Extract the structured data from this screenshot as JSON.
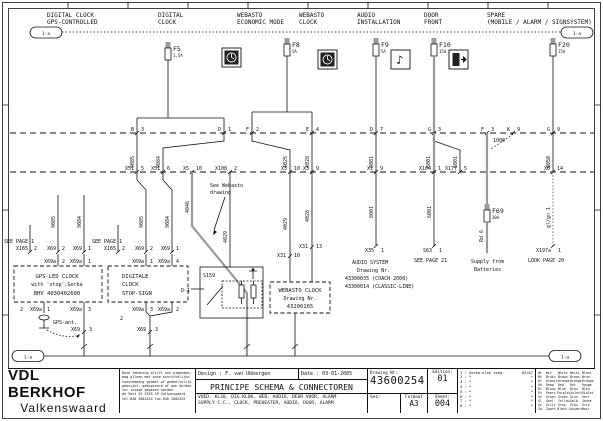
{
  "t": {
    "bub": "1-a",
    "h1a": "DIGITAL CLOCK",
    "h1b": "GPS-CONTROLLED",
    "h2a": "DIGITAL",
    "h2b": "CLOCK",
    "h3a": "WEBASTO",
    "h3b": "ECONOMIC MODE",
    "h4a": "WEBASTO",
    "h4b": "CLOCK",
    "h5a": "AUDIO",
    "h5b": "INSTALLATION",
    "h6a": "DOOR",
    "h6b": "FRONT",
    "h7a": "SPARE",
    "h7b": "(MOBILE / ALARM / SIGNSYSTEM)",
    "see1": "SEE PAGE 1",
    "seew1": "See Webasto",
    "seew2": "drawing",
    "see21": "SEE PAGE 21",
    "sup1": "Supply from",
    "sup2": "Batteries",
    "look20": "LOOK PAGE 20",
    "gpsant": "GPS-ant.",
    "s159": "S159",
    "d1": "D-1",
    "two": "2"
  },
  "fuses": {
    "f5": {
      "name": "F5",
      "rating": "1,5A"
    },
    "f8": {
      "name": "F8",
      "rating": "5A"
    },
    "f9": {
      "name": "F9",
      "rating": "5A"
    },
    "f10": {
      "name": "F10",
      "rating": "15A"
    },
    "f20": {
      "name": "F20",
      "rating": "15A"
    },
    "f69": {
      "name": "F69",
      "rating": "30A"
    }
  },
  "bus1": [
    {
      "l": "B",
      "n": "3"
    },
    {
      "l": "D",
      "n": "1"
    },
    {
      "l": "F",
      "n": "2"
    },
    {
      "l": "E",
      "n": "4"
    },
    {
      "l": "D",
      "n": "7"
    },
    {
      "l": "G",
      "n": "3"
    },
    {
      "l": "F",
      "n": "3"
    },
    {
      "l": "K",
      "n": "9"
    },
    {
      "l": "G",
      "n": "9"
    }
  ],
  "bus2": [
    {
      "c": "X51",
      "p": "5"
    },
    {
      "c": "X51",
      "p": "6"
    },
    {
      "c": "X5",
      "p": "10"
    },
    {
      "c": "X108",
      "p": "2"
    },
    {
      "c": "X3",
      "p": "10"
    },
    {
      "c": "X3",
      "p": "9"
    },
    {
      "c": "X1",
      "p": "9"
    },
    {
      "c": "X104",
      "p": "1"
    },
    {
      "c": "X177",
      "p": "5"
    },
    {
      "c": "X6",
      "p": "14"
    }
  ],
  "wu": {
    "a": "9085",
    "b": "9084",
    "c": "4025",
    "d": "4028",
    "e": "8001",
    "f": "6001",
    "g": "6001",
    "h": "1000",
    "i": "8050"
  },
  "wd": {
    "a": "9085",
    "b": "9084",
    "c": "9085",
    "d": "9084",
    "e": "4046",
    "f": "4029",
    "g": "4029",
    "h": "4028",
    "i": "8001",
    "j": "6001",
    "k": "Rd 6",
    "l": "gl/gn 1"
  },
  "cr1": [
    {
      "c": "X165",
      "p": "2"
    },
    {
      "c": "X69",
      "p": "2"
    },
    {
      "c": "X69",
      "p": "1"
    },
    {
      "c": "X165",
      "p": "2"
    },
    {
      "c": "X69",
      "p": "2"
    },
    {
      "c": "X69",
      "p": "1"
    }
  ],
  "cr2": [
    {
      "c": "X69a",
      "p": "2"
    },
    {
      "c": "X69a",
      "p": "1"
    },
    {
      "c": "X69a",
      "p": "1"
    },
    {
      "c": "X69a",
      "p": "4"
    }
  ],
  "cr3": [
    {
      "c": "X69a",
      "p": "1"
    },
    {
      "c": "X69a",
      "p": "3"
    },
    {
      "c": "X69a",
      "p": "3"
    },
    {
      "c": "X69a",
      "p": "2"
    }
  ],
  "cr4": [
    {
      "c": "X69",
      "p": "3"
    },
    {
      "c": "X69",
      "p": "3"
    }
  ],
  "mc": {
    "x31a": {
      "c": "X31",
      "p": "10"
    },
    "x31b": {
      "c": "X31",
      "p": "13"
    },
    "x35": {
      "c": "X35",
      "p": "1"
    },
    "s63": {
      "c": "S63",
      "p": "1"
    },
    "x197": {
      "c": "X197a",
      "p": "1"
    }
  },
  "box1": {
    "l1": "GPS-LED CLOCK",
    "l2": "with 'stop',Gorba",
    "l3": "BHV 4030402600"
  },
  "box2": {
    "l1": "DIGITALE",
    "l2": "CLOCK",
    "l3": "STOP-SIGN"
  },
  "wbox": {
    "l1": "WEBASTO CLOCK",
    "l2": "Drawing Nr.",
    "l3": "43200165"
  },
  "audio": {
    "l1": "AUDIO SYSTEM",
    "l2": "Drawing Nr.",
    "l3": "43300035 (COACH 2000)",
    "l4": "43300014 (CLASSIC-LINE)"
  },
  "tb": {
    "company1": "VDL BERKHOF",
    "company2": "Valkenswaard",
    "disclaimer": [
      "Deze tekening blijft ons eigendom,",
      "mag alleen met onze schriftelijke",
      "toestemming geheel of gedeeltelijk",
      "gebruikt, gekopieerd of aan derden",
      "ter inzage gegeven worden.",
      " ",
      "de Vest 55 5555 XP Valkenswaard",
      "tel.040 2082424 fax.040 2082425"
    ],
    "design": "Design : F. van Ubbergen",
    "date": "Date : 03-01-2005",
    "title": "PRINCIPE SCHEMA & CONNECTOREN",
    "sub1": "VOED. KL30, DIG.KLOK, WEB, AUDIO, DEUR VOOR, ALARM",
    "sub2": "SUPPLY C.C., CLOCK, PREHEATER, AUDIO, DOOR, ALARM",
    "drawing_label": "Drawing Nr:",
    "drawing_nr": "43600254",
    "gez": "Gez:",
    "formaat_label": "Formaat",
    "formaat": "A3",
    "edition_label": "Edition:",
    "edition": "01",
    "sheet_label": "Sheet:",
    "sheet": "004",
    "editions": [
      {
        "n": "1 : Gorba-klok toeg.",
        "d": "03/07"
      },
      {
        "n": "2 : *",
        "d": "*"
      },
      {
        "n": "3 : *",
        "d": "*"
      },
      {
        "n": "4 : *",
        "d": "*"
      },
      {
        "n": "5 : *",
        "d": "*"
      },
      {
        "n": "6 : *",
        "d": "*"
      },
      {
        "n": "7 : *",
        "d": "*"
      },
      {
        "n": "8 : *",
        "d": "*"
      }
    ],
    "legend": [
      {
        "c": "Wt",
        "nl": "Wit",
        "en": "White",
        "de": "Weiss",
        "fr": "Blanc"
      },
      {
        "c": "Bn",
        "nl": "Bruin",
        "en": "Brown",
        "de": "Braun",
        "fr": "Brun"
      },
      {
        "c": "Or",
        "nl": "Oranje",
        "en": "Orange",
        "de": "Orange",
        "fr": "Orange"
      },
      {
        "c": "Rd",
        "nl": "Rood",
        "en": "Red",
        "de": "Rot",
        "fr": "Rouge"
      },
      {
        "c": "Bl",
        "nl": "Blauw",
        "en": "Blue",
        "de": "Blau",
        "fr": "Bleu"
      },
      {
        "c": "Pu",
        "nl": "Paars",
        "en": "Purple",
        "de": "Violett",
        "fr": "Violet"
      },
      {
        "c": "Gn",
        "nl": "Groen",
        "en": "Green",
        "de": "Grun",
        "fr": "Vert"
      },
      {
        "c": "Gl",
        "nl": "Geel",
        "en": "Yellow",
        "de": "Gelb",
        "fr": "Jaune"
      },
      {
        "c": "Gs",
        "nl": "Grijs",
        "en": "Grey",
        "de": "Grau",
        "fr": "Gris"
      },
      {
        "c": "Zw",
        "nl": "Zwart",
        "en": "Black",
        "de": "Schwarz",
        "fr": "Noir"
      }
    ]
  },
  "colors": {
    "wire_gray": "#9a9a9a",
    "line": "#111111"
  }
}
